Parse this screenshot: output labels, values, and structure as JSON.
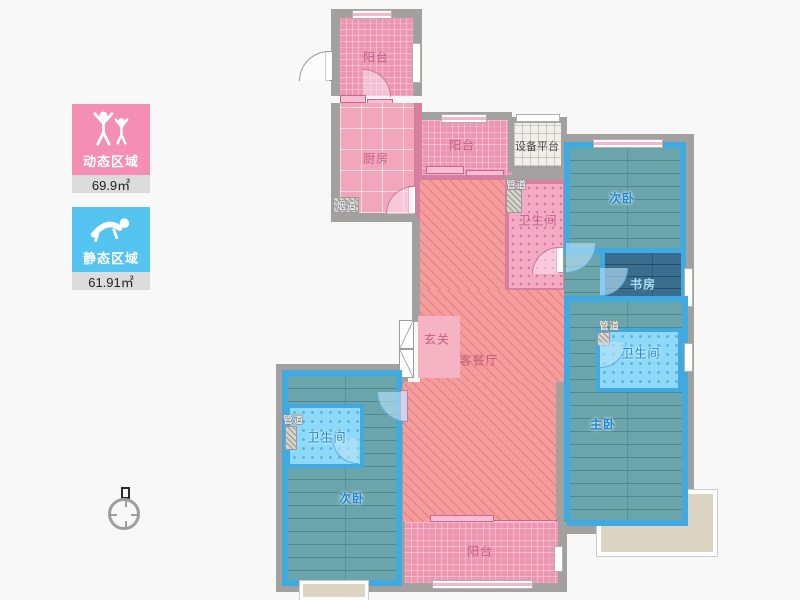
{
  "legend": {
    "dynamic": {
      "label": "动态区域",
      "value": "69.9㎡",
      "color": "#F48FB3"
    },
    "static": {
      "label": "静态区域",
      "value": "61.91㎡",
      "color": "#55C4F0"
    }
  },
  "rooms": {
    "balcony_top": "阳台",
    "kitchen": "厨房",
    "flue": "烟道",
    "balcony_mid": "阳台",
    "equipment_platform": "设备平台",
    "duct_top": "管道",
    "bath_top": "卫生间",
    "bedroom_top": "次卧",
    "study": "书房",
    "duct_right": "管道",
    "bath_right": "卫生间",
    "master_bedroom": "主卧",
    "foyer": "玄关",
    "living_dining": "客餐厅",
    "duct_left": "管道",
    "bath_left": "卫生间",
    "bedroom_bottom": "次卧",
    "balcony_bottom": "阳台"
  }
}
